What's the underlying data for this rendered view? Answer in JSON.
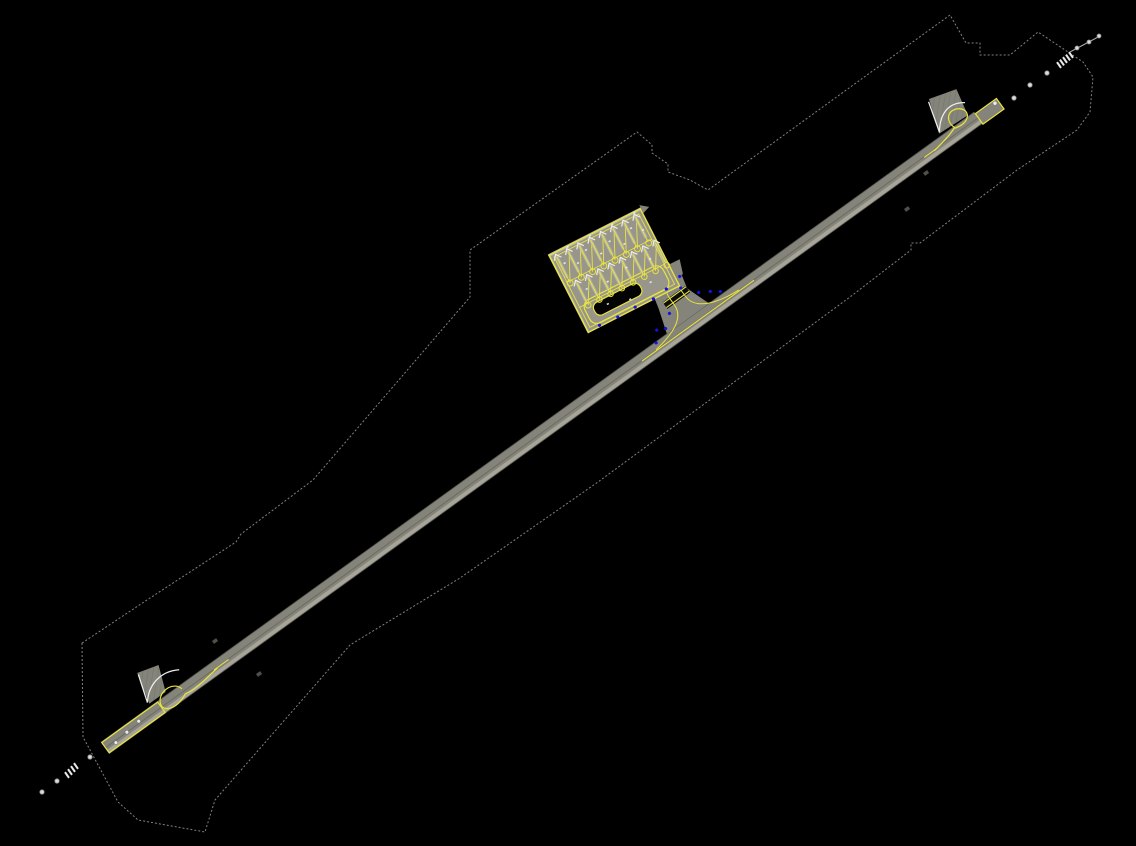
{
  "scene": {
    "description": "CAD site-plan drawing of an airport: single diagonal runway with turnaround pads at both ends, a terminal apron with two rows of aircraft parking stands, a connector taxiway, approach lighting and a property boundary line on a black model-space background",
    "background": "#000000"
  },
  "colors": {
    "pavement": "#85847a",
    "pavement_light": "#a7a599",
    "pavement_edge": "#5a594f",
    "centerline_gray": "#6b6a5e",
    "apron": "#98968a",
    "apron_edge_band": "#b7b5a8",
    "stand_strip": "#b9b7aa",
    "marking_yellow": "#e9e43e",
    "marking_white": "#ececec",
    "light_blue": "#1414e0",
    "boundary_gray": "#8f8f8f",
    "annotation_gray": "#50504a",
    "island_fill": "#030303",
    "holdbar_fill": "#0c0c0c"
  },
  "runway": {
    "origin_x": 105,
    "origin_y": 748,
    "angle_deg": -35.82,
    "length": 1077,
    "width": 14,
    "sw_end_pad": {
      "x": 0.6,
      "y": -6.4,
      "w": 69,
      "h": 12.8
    },
    "ne_blast_pad": {
      "x": 1077,
      "y": -5,
      "w": 26,
      "h": 13
    },
    "ne_pad_dot": [
      1099,
      -2
    ],
    "threshold_dots_sw": [
      [
        12,
        2
      ],
      [
        27,
        0
      ],
      [
        43,
        -2
      ]
    ]
  },
  "apron": {
    "origin_x": 548,
    "origin_y": 255,
    "angle_deg": -27,
    "w": 104,
    "h": 88,
    "stand_rows": [
      {
        "count": 8,
        "x0": 7,
        "dx": 12.6,
        "chevron_y": 4,
        "strip_len": 26,
        "loop_y": 35
      },
      {
        "count": 8,
        "x0": 13,
        "dx": 12.6,
        "chevron_y": 36,
        "strip_len": 24,
        "loop_y": 63
      }
    ],
    "taxilane_lines_y": [
      33,
      61
    ],
    "island": {
      "x": 16,
      "y": 64,
      "w": 52,
      "h": 14,
      "r": 6
    },
    "lane_loop": {
      "x": 8,
      "y": 58,
      "w": 88,
      "h": 26,
      "r": 8
    },
    "sprinkles": [
      [
        10,
        14
      ],
      [
        22,
        20
      ],
      [
        35,
        12
      ],
      [
        47,
        22
      ],
      [
        60,
        15
      ],
      [
        72,
        24
      ],
      [
        85,
        13
      ],
      [
        95,
        20
      ],
      [
        18,
        47
      ],
      [
        40,
        50
      ],
      [
        63,
        46
      ],
      [
        88,
        49
      ],
      [
        30,
        70
      ],
      [
        52,
        76
      ],
      [
        78,
        70
      ],
      [
        20,
        1
      ],
      [
        45,
        1
      ],
      [
        70,
        1
      ],
      [
        95,
        1
      ]
    ],
    "blue_lights_local": [
      [
        14,
        86
      ],
      [
        34,
        87
      ],
      [
        54,
        86
      ],
      [
        74,
        87
      ],
      [
        90,
        84
      ]
    ]
  },
  "connector": {
    "blue_lights_runway_frame": [
      [
        722,
        -50
      ],
      [
        742,
        -46
      ],
      [
        712,
        -22
      ],
      [
        748,
        -22
      ],
      [
        700,
        -12
      ],
      [
        766,
        -10
      ],
      [
        684,
        -6
      ],
      [
        736,
        -36
      ],
      [
        758,
        -16
      ],
      [
        692,
        -16
      ]
    ]
  },
  "approach_lights_ne": {
    "dots": [
      [
        1014,
        98
      ],
      [
        1030,
        85
      ],
      [
        1047,
        73
      ]
    ],
    "ladder": {
      "cx": 1059,
      "cy": 65,
      "count": 5,
      "step_x": 3,
      "step_y": -2.5,
      "angle": 55
    },
    "tail_line": [
      1070,
      52,
      1100,
      36
    ],
    "tail_dots": [
      [
        1077,
        48
      ],
      [
        1089,
        42
      ],
      [
        1099,
        36
      ]
    ]
  },
  "approach_lights_sw": {
    "dots": [
      [
        42,
        792
      ],
      [
        57,
        781
      ],
      [
        90,
        757
      ]
    ],
    "ladder": {
      "cx": 67,
      "cy": 775,
      "count": 4,
      "step_x": 3,
      "step_y": -3,
      "angle": 55
    },
    "tail_line": null,
    "tail_dots": []
  },
  "boundary": {
    "points": "82,643 150,598 236,542 241,534 313,480 470,297 470,250 637,132 652,145 652,153 668,164 668,172 690,180 708,190 950,15 966,43 980,43 980,55 1010,55 1038,32 1083,62 1093,77 1090,112 1077,130 1017,170 920,243 911,243 911,250 850,297 598,482 460,578 350,645 215,800 205,832 138,820 118,802 83,737"
  },
  "annotation_marks": [
    [
      212,
      641
    ],
    [
      256,
      674
    ],
    [
      923,
      173
    ],
    [
      904,
      209
    ]
  ],
  "counts": {
    "parking_stands": 16,
    "approach_dots_ne": 3,
    "approach_dots_sw": 3
  }
}
